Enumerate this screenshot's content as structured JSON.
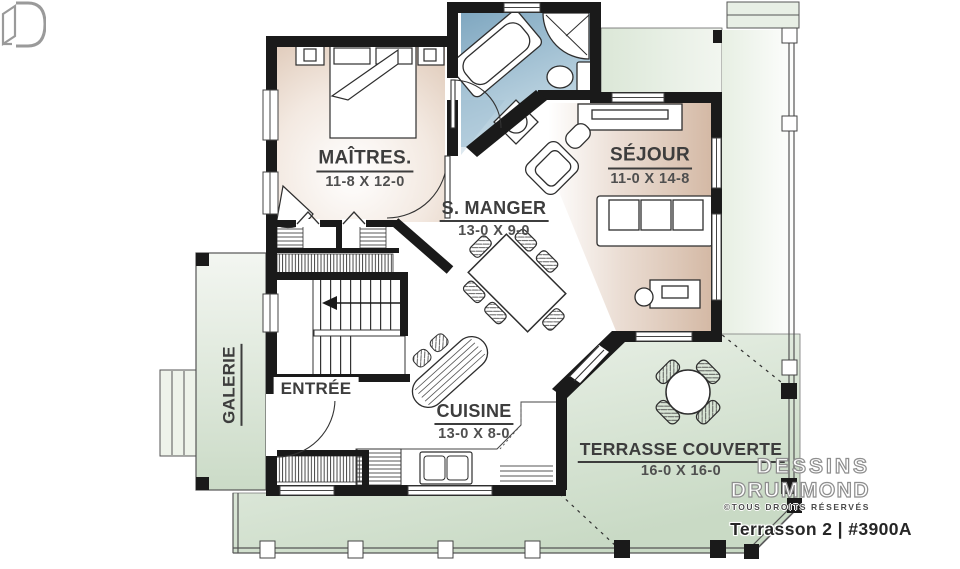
{
  "plan": {
    "title": "Terrasson 2 | #3900A"
  },
  "branding": {
    "line1": "DESSINS",
    "line2": "DRUMMOND",
    "copyright": "©TOUS DROITS RÉSERVÉS"
  },
  "rooms": {
    "master": {
      "name": "MAÎTRES.",
      "dims": "11-8 X 12-0"
    },
    "living": {
      "name": "SÉJOUR",
      "dims": "11-0 X 14-8"
    },
    "dining": {
      "name": "S. MANGER",
      "dims": "13-0 X 9-0"
    },
    "entry": {
      "name": "ENTRÉE"
    },
    "kitchen": {
      "name": "CUISINE",
      "dims": "13-0 X 8-0"
    },
    "terrace": {
      "name": "TERRASSE COUVERTE",
      "dims": "16-0 X 16-0"
    },
    "gallery": {
      "name": "GALERIE"
    }
  },
  "colors": {
    "wall": "#1a1a1a",
    "room_beige": "#d9c0ae",
    "bath_blue": "#7fa7c0",
    "porch_green": "#cbdbc7",
    "label": "#3d3d3d"
  }
}
